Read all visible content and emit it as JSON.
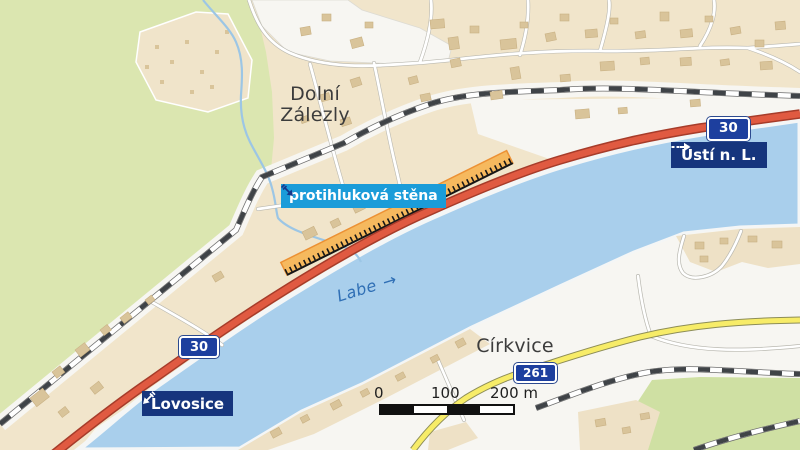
{
  "map": {
    "places": {
      "dolni_zalezly_line1": "Dolní",
      "dolni_zalezly_line2": "Zálezly",
      "cirkvice": "Církvice"
    },
    "river": {
      "name": "Labe",
      "arrow": "→"
    },
    "highlight": {
      "label": "protihluková stěna"
    },
    "directions": {
      "usti": "Ústí n. L.",
      "lovosice": "Lovosice"
    },
    "route_shields": {
      "route_30_upper": "30",
      "route_30_lower": "30",
      "route_261": "261"
    },
    "scale_bar": {
      "tick_0": "0",
      "tick_100": "100",
      "tick_200": "200 m"
    },
    "colors": {
      "highlight_badge": "#1b9cd9",
      "direction_badge": "#16357d",
      "route_shield": "#1d3f9e",
      "noise_barrier_fill": "#f6b95e",
      "noise_barrier_edge": "#e9922f",
      "road_primary_fill": "#e05a41",
      "road_primary_casing": "#a63c2a",
      "road_secondary_fill": "#f7ec68",
      "river": "#a9cfec",
      "stream": "#9cc6e5",
      "field_green": "#dbe6b0",
      "field_green_far": "#cfe0a3",
      "settlement": "#f1e5cb",
      "settlement_far": "#eee1c6",
      "building": "#d9c49a",
      "railway_dash": "#3f4347"
    }
  }
}
